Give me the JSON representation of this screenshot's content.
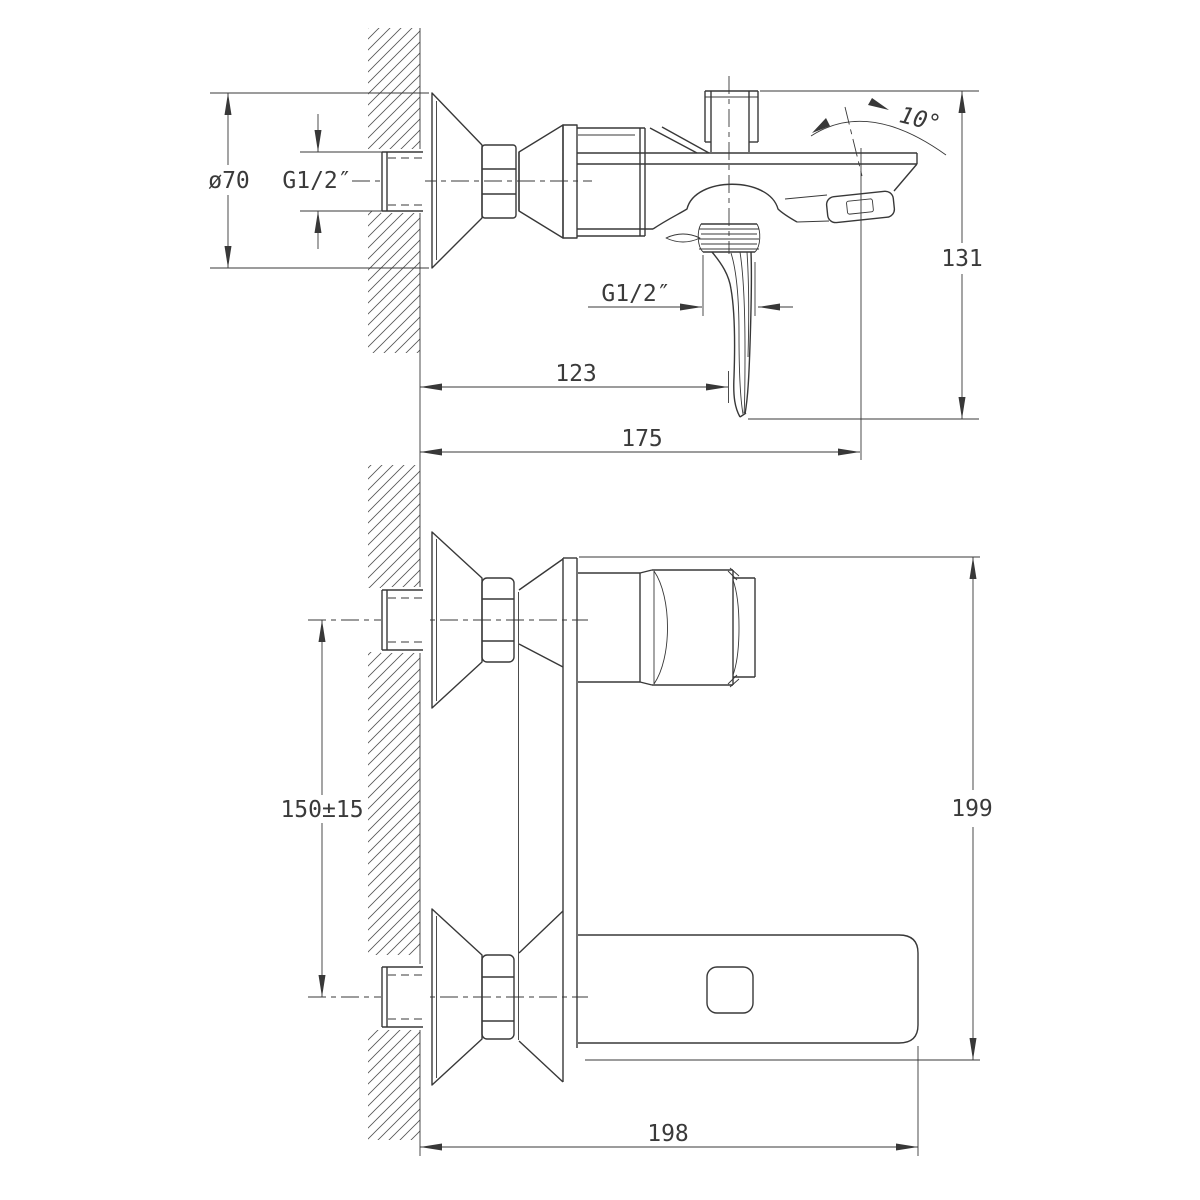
{
  "drawing": {
    "type": "technical-installation-drawing",
    "subject": "Wall-mounted bath/shower mixer with spout - installation dimension drawing, two orthographic views",
    "colors": {
      "background": "#ffffff",
      "lines": "#383838",
      "text": "#3a3a3a"
    },
    "side_view": {
      "label": "side view (upper)",
      "dims": {
        "flange_diameter": "ø70",
        "inlet_thread": "G1/2″",
        "spout_angle": "10°",
        "overall_height": "131",
        "shower_outlet_thread": "G1/2″",
        "wall_to_handle": "123",
        "wall_to_spout_tip": "175"
      }
    },
    "front_view": {
      "label": "front view (lower)",
      "dims": {
        "inlet_spacing": "150±15",
        "overall_height": "199",
        "overall_length": "198"
      }
    }
  }
}
